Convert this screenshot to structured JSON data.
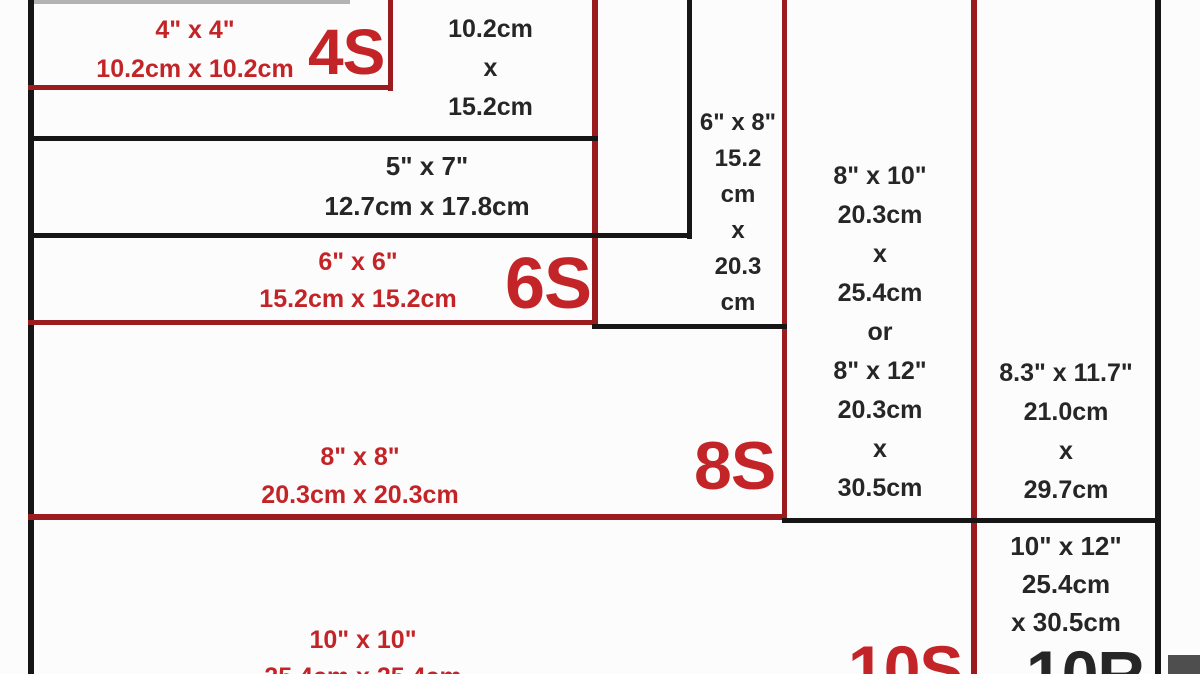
{
  "diagram": {
    "description": "Photo print size comparison chart",
    "colors": {
      "red_line": "#9a1c1e",
      "red_text": "#c32427",
      "black_line": "#161616",
      "black_text": "#262626",
      "background": "#fcfcfc"
    },
    "sizes": [
      {
        "id": "4x4",
        "code": "4S",
        "inches": "4\" x 4\"",
        "cm": "10.2cm x 10.2cm"
      },
      {
        "id": "4x6",
        "code": "",
        "inches": "4\" x 6\"",
        "cm": "10.2cm\nx\n15.2cm"
      },
      {
        "id": "5x7",
        "code": "",
        "inches": "5\" x 7\"",
        "cm": "12.7cm x 17.8cm"
      },
      {
        "id": "6x6",
        "code": "6S",
        "inches": "6\" x 6\"",
        "cm": "15.2cm x 15.2cm"
      },
      {
        "id": "6x8",
        "code": "",
        "inches": "6\" x 8\"",
        "cm": "15.2\ncm\nx\n20.3\ncm"
      },
      {
        "id": "8x8",
        "code": "8S",
        "inches": "8\" x 8\"",
        "cm": "20.3cm x 20.3cm"
      },
      {
        "id": "8x10",
        "code": "",
        "inches": "8\" x 10\"",
        "cm": "20.3cm\nx\n25.4cm",
        "or": "or",
        "inches2": "8\" x 12\"",
        "cm2": "20.3cm\nx\n30.5cm"
      },
      {
        "id": "a4",
        "code": "",
        "inches": "8.3\" x 11.7\"",
        "cm": "21.0cm\nx\n29.7cm"
      },
      {
        "id": "10x12",
        "code": "10R",
        "inches": "10\" x 12\"",
        "cm": "25.4cm\nx 30.5cm"
      },
      {
        "id": "10x10",
        "code": "10S",
        "inches": "10\" x 10\"",
        "cm": "25.4cm x 25.4cm"
      }
    ]
  }
}
